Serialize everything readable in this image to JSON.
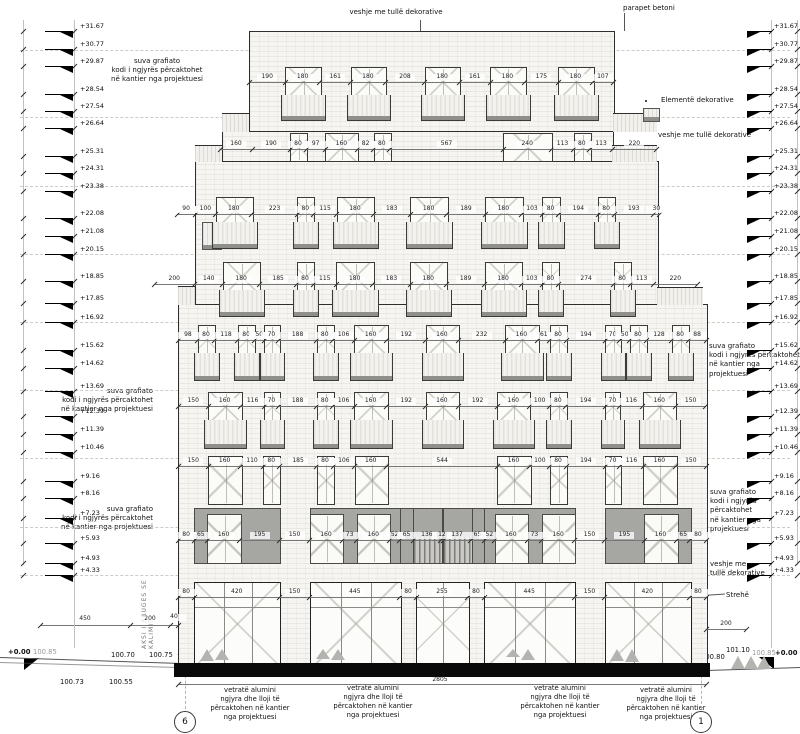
{
  "annotations": {
    "veshje_tulle_dekorative": "veshje me tullë dekorative",
    "parapet_betoni": "parapet betoni",
    "suva_grafiato": "suva grafiato\nkodi i ngjyrës përcaktohet\nnë kantier nga projektuesi",
    "elemente_dekorative": "Elementë dekorative",
    "veshje_me_tulle": "veshje me tullë",
    "veshje_me_tulle_dekorative_2l": "veshje me\ntullë dekorative",
    "strehe": "Strehë",
    "vetrate": "vetratë alumini\nngjyra dhe lloji të\npërcaktohen në kantier\nnga projektuesi",
    "aksi": "AKSI I RRUGES SE KALIMIT"
  },
  "levels": [
    {
      "v": "+31.67",
      "y": 31
    },
    {
      "v": "+30.77",
      "y": 49
    },
    {
      "v": "+29.87",
      "y": 66
    },
    {
      "v": "+28.54",
      "y": 94
    },
    {
      "v": "+27.54",
      "y": 111
    },
    {
      "v": "+26.64",
      "y": 128
    },
    {
      "v": "+25.31",
      "y": 156
    },
    {
      "v": "+24.31",
      "y": 173
    },
    {
      "v": "+23.38",
      "y": 191
    },
    {
      "v": "+22.08",
      "y": 218
    },
    {
      "v": "+21.08",
      "y": 236
    },
    {
      "v": "+20.15",
      "y": 254
    },
    {
      "v": "+18.85",
      "y": 281
    },
    {
      "v": "+17.85",
      "y": 303
    },
    {
      "v": "+16.92",
      "y": 322
    },
    {
      "v": "+15.62",
      "y": 350
    },
    {
      "v": "+14.62",
      "y": 368
    },
    {
      "v": "+13.69",
      "y": 391
    },
    {
      "v": "+12.39",
      "y": 416
    },
    {
      "v": "+11.39",
      "y": 434
    },
    {
      "v": "+10.46",
      "y": 452
    },
    {
      "v": "+9.16",
      "y": 481
    },
    {
      "v": "+8.16",
      "y": 498
    },
    {
      "v": "+7.23",
      "y": 518
    },
    {
      "v": "+5.93",
      "y": 543
    },
    {
      "v": "+4.93",
      "y": 563
    },
    {
      "v": "+4.33",
      "y": 575
    }
  ],
  "floors": [
    {
      "id": "floor-8",
      "x0": 249,
      "scale": 0.1914,
      "dim_y": 82,
      "dims": [
        190,
        180,
        161,
        180,
        208,
        180,
        161,
        180,
        175,
        180,
        107
      ],
      "windows": [
        1,
        3,
        5,
        7,
        9
      ],
      "style": "balcony",
      "wy": [
        67,
        95,
        120
      ]
    },
    {
      "id": "floor-7",
      "x0": 220,
      "scale": 0.2,
      "dim_y": 149,
      "dims": [
        160,
        190,
        80,
        97,
        160,
        82,
        80,
        567,
        240,
        113,
        80,
        113,
        220
      ],
      "windows": [
        2,
        4,
        6,
        8,
        10
      ],
      "style": "plain",
      "wy": [
        133,
        160
      ]
    },
    {
      "id": "floor-6",
      "x0": 177,
      "scale": 0.2027,
      "dim_y": 214,
      "dims": [
        90,
        100,
        180,
        223,
        80,
        115,
        180,
        183,
        180,
        189,
        180,
        103,
        80,
        194,
        80,
        193,
        30
      ],
      "windows": [
        2,
        4,
        6,
        8,
        10,
        12,
        14
      ],
      "style": "balcony",
      "wy": [
        197,
        222,
        248
      ]
    },
    {
      "id": "floor-5",
      "x0": 154,
      "scale": 0.2027,
      "dim_y": 284,
      "dims": [
        200,
        140,
        180,
        185,
        80,
        115,
        180,
        183,
        180,
        189,
        180,
        103,
        80,
        274,
        80,
        113,
        220
      ],
      "windows": [
        2,
        4,
        6,
        8,
        10,
        12,
        14
      ],
      "style": "balcony",
      "wy": [
        262,
        290,
        316
      ]
    },
    {
      "id": "floor-4",
      "x0": 178,
      "scale": 0.2027,
      "dim_y": 340,
      "dims": [
        98,
        80,
        118,
        80,
        50,
        70,
        188,
        80,
        106,
        160,
        192,
        160,
        232,
        160,
        61,
        80,
        194,
        70,
        50,
        80,
        128,
        80,
        88
      ],
      "windows": [
        1,
        3,
        5,
        7,
        9,
        11,
        13,
        15,
        17,
        19,
        21
      ],
      "style": "balcony",
      "wy": [
        325,
        353,
        380
      ]
    },
    {
      "id": "floor-3",
      "x0": 178,
      "scale": 0.2027,
      "dim_y": 406,
      "dims": [
        150,
        160,
        116,
        70,
        188,
        80,
        106,
        160,
        192,
        160,
        192,
        160,
        100,
        80,
        194,
        70,
        116,
        160,
        150
      ],
      "windows": [
        1,
        3,
        5,
        7,
        9,
        11,
        13,
        15,
        17
      ],
      "style": "balcony",
      "wy": [
        392,
        420,
        448
      ]
    },
    {
      "id": "floor-2",
      "x0": 178,
      "scale": 0.2027,
      "dim_y": 466,
      "dims": [
        150,
        160,
        110,
        80,
        185,
        80,
        106,
        160,
        544,
        160,
        100,
        80,
        194,
        70,
        116,
        160,
        150
      ],
      "windows": [
        1,
        3,
        5,
        7,
        9,
        11,
        13,
        15
      ],
      "style": "flat",
      "wy": [
        456,
        503
      ]
    },
    {
      "id": "mezzanine",
      "x0": 178,
      "scale": 0.2027,
      "dim_y": 540,
      "dims": [
        80,
        65,
        160,
        195,
        150,
        160,
        73,
        160,
        52,
        65,
        136,
        12,
        137,
        65,
        52,
        160,
        73,
        160,
        150,
        195,
        160,
        65,
        80
      ],
      "windows": [],
      "style": "mezz",
      "wy": [
        508,
        562
      ],
      "blocks": [
        {
          "s": 1,
          "e": 3,
          "doors": [
            2
          ]
        },
        {
          "s": 5,
          "e": 8,
          "doors": [
            5,
            7
          ]
        },
        {
          "s": 9,
          "e": 13,
          "stairs": [
            10,
            12
          ]
        },
        {
          "s": 14,
          "e": 17,
          "doors": [
            15,
            17
          ]
        },
        {
          "s": 19,
          "e": 21,
          "doors": [
            20
          ]
        }
      ]
    },
    {
      "id": "ground-floor",
      "x0": 178,
      "scale": 0.2027,
      "dim_y": 597,
      "dims": [
        80,
        420,
        150,
        445,
        80,
        255,
        80,
        445,
        150,
        420,
        80
      ],
      "windows": [
        1,
        3,
        5,
        7,
        9
      ],
      "style": "storefront",
      "wy": [
        582,
        663
      ]
    }
  ],
  "structure": {
    "masses": [
      [
        249,
        31,
        613,
        131
      ],
      [
        222,
        131,
        612,
        161
      ],
      [
        195,
        161,
        657,
        304
      ],
      [
        178,
        304,
        706,
        663
      ]
    ],
    "base": [
      174,
      663,
      710,
      677
    ],
    "parapets": [
      [
        222,
        113,
        249,
        131
      ],
      [
        613,
        113,
        657,
        131
      ],
      [
        195,
        145,
        222,
        161
      ],
      [
        612,
        145,
        657,
        161
      ],
      [
        178,
        286,
        195,
        304
      ],
      [
        657,
        287,
        703,
        304
      ]
    ],
    "railing": [
      202,
      222,
      220,
      248
    ],
    "decor_element": [
      643,
      108,
      658,
      120
    ],
    "dashes_y": [
      50,
      117,
      186,
      254,
      322,
      390,
      458,
      527,
      575
    ],
    "canopy": [
      628,
      601,
      660,
      607
    ]
  },
  "site": {
    "dimrows": [
      {
        "line": [
          40,
          625,
          178
        ],
        "ticks": [
          40,
          130,
          170,
          178
        ],
        "labels": [
          {
            "v": "450",
            "x": 85,
            "y": 616
          },
          {
            "v": "200",
            "x": 150,
            "y": 616
          },
          {
            "v": "40",
            "x": 174,
            "y": 614
          }
        ]
      },
      {
        "line": [
          706,
          629,
          746
        ],
        "ticks": [
          706,
          746
        ],
        "labels": [
          {
            "v": "200",
            "x": 726,
            "y": 621
          }
        ]
      },
      {
        "line": [
          178,
          684,
          706
        ],
        "ticks": [
          178,
          706
        ],
        "labels": [
          {
            "v": "2805",
            "x": 440,
            "y": 677
          }
        ]
      }
    ],
    "spots": {
      "zero_left": "+0.00",
      "s10085_left": "100.85",
      "s10070": "100.70",
      "s10075": "100.75",
      "s10080_left": "100.80",
      "s10073": "100.73",
      "s10055": "100.55",
      "s10080_right": "100.80",
      "s10110": "101.10",
      "s10085_right": "100.85",
      "zero_right": "+0.00"
    },
    "axes": {
      "left": "6",
      "right": "1"
    },
    "bushes_right_x": [
      731,
      744,
      757
    ],
    "bushes_ground_x": [
      200,
      215,
      316,
      331,
      506,
      521,
      610,
      625
    ]
  },
  "colors": {
    "line": "#2e2e2e",
    "brick": "#f6f5f1",
    "gray_panel": "#a6a6a2",
    "sill": "#8f8f8b",
    "dash": "#cccbc6",
    "black": "#0a0a0a"
  }
}
